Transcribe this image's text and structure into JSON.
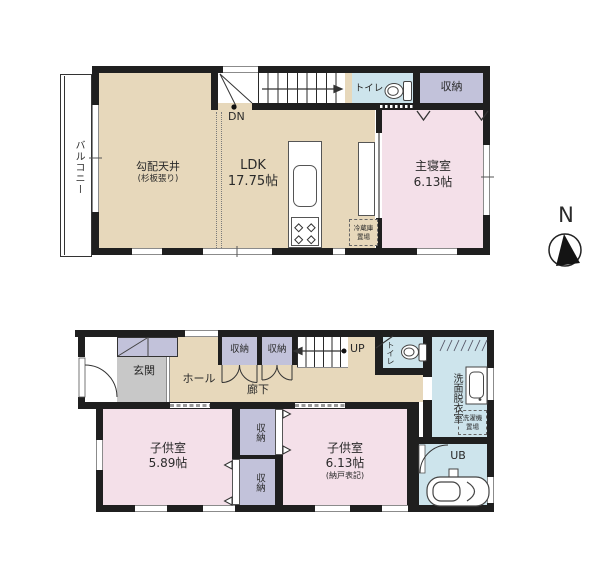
{
  "compass": {
    "label": "N"
  },
  "floor2": {
    "balcony": "バルコニー",
    "sloped_ceiling": "勾配天井",
    "sloped_ceiling_note": "(杉板張り)",
    "ldk": "LDK",
    "ldk_size": "17.75帖",
    "stairs_down": "DN",
    "toilet": "トイレ",
    "storage": "収納",
    "master_bedroom": "主寝室",
    "master_bedroom_size": "6.13帖",
    "fridge_line1": "冷蔵庫",
    "fridge_line2": "置場"
  },
  "floor1": {
    "entrance": "玄関",
    "hall": "ホール",
    "corridor": "廊下",
    "storage_a": "収納",
    "storage_b": "収納",
    "stairs_up": "UP",
    "toilet": "トイレ",
    "washroom": "洗面脱衣室",
    "laundry_line1": "洗濯機",
    "laundry_line2": "置場",
    "bath": "UB",
    "child_room1": "子供室",
    "child_room1_size": "5.89帖",
    "child_room2": "子供室",
    "child_room2_size": "6.13帖",
    "child_room2_note": "(納戸表記)",
    "storage_mid_top": "収納",
    "storage_mid_bottom": "収納"
  },
  "colors": {
    "wall": "#1f1f1f",
    "floor_wood": "#e7d8bb",
    "room_pink": "#f4e0e9",
    "closet_lavender": "#c2c2da",
    "wet_area_blue": "#cde4ec",
    "entrance_gray": "#c8c8c8",
    "window_gray": "#8b8b8b"
  }
}
